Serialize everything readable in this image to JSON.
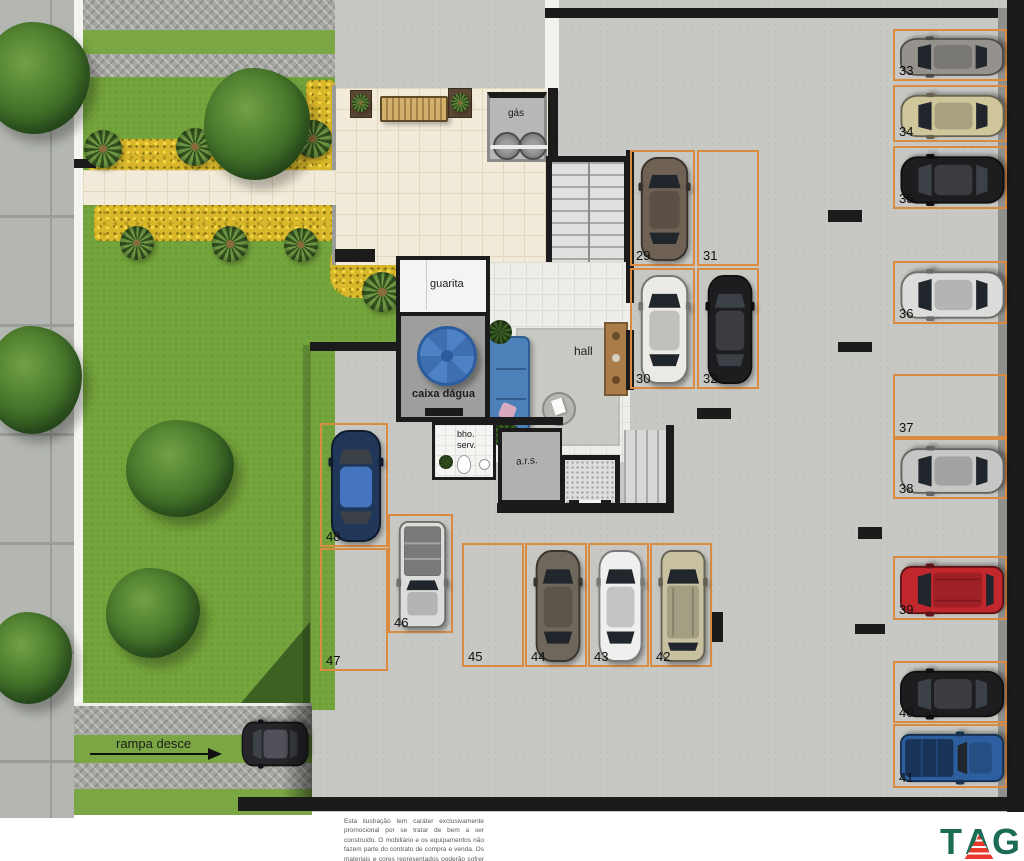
{
  "plan": {
    "labels": {
      "gas": "gás",
      "guarita": "guarita",
      "caixa_dagua": "caixa dágua",
      "hall": "hall",
      "bho_serv_line1": "bho.",
      "bho_serv_line2": "serv.",
      "ars": "a.r.s.",
      "ramp": "rampa desce"
    },
    "colors": {
      "stall_outline": "#db8b41",
      "garage_floor": "#c7c8c4",
      "lawn": "#74a43c",
      "flowers": "#d9b72b",
      "water_tank": "#4d82c4",
      "logo_green": "#1c6b55",
      "logo_red": "#e8392c"
    },
    "stalls": [
      {
        "num": "29",
        "x": 630,
        "y": 150,
        "w": 65,
        "h": 116,
        "dir": "v",
        "car": {
          "color": "#6f6255",
          "type": "sedan"
        }
      },
      {
        "num": "30",
        "x": 630,
        "y": 268,
        "w": 65,
        "h": 121,
        "dir": "v",
        "car": {
          "color": "#eceae6",
          "type": "sedan"
        }
      },
      {
        "num": "31",
        "x": 697,
        "y": 150,
        "w": 62,
        "h": 116,
        "dir": "v",
        "car": null
      },
      {
        "num": "32",
        "x": 697,
        "y": 268,
        "w": 62,
        "h": 121,
        "dir": "v",
        "car": {
          "color": "#1d1d1f",
          "type": "sedan"
        }
      },
      {
        "num": "33",
        "x": 893,
        "y": 29,
        "w": 114,
        "h": 52,
        "dir": "h",
        "car": {
          "color": "#95928d",
          "type": "sedan"
        }
      },
      {
        "num": "34",
        "x": 893,
        "y": 85,
        "w": 114,
        "h": 57,
        "dir": "h",
        "car": {
          "color": "#cfc69b",
          "type": "sedan"
        }
      },
      {
        "num": "35",
        "x": 893,
        "y": 146,
        "w": 114,
        "h": 63,
        "dir": "h",
        "car": {
          "color": "#1d1d1f",
          "type": "sedan"
        }
      },
      {
        "num": "36",
        "x": 893,
        "y": 261,
        "w": 114,
        "h": 63,
        "dir": "h",
        "car": {
          "color": "#dcdcda",
          "type": "sedan"
        }
      },
      {
        "num": "37",
        "x": 893,
        "y": 374,
        "w": 114,
        "h": 64,
        "dir": "h",
        "car": null
      },
      {
        "num": "38",
        "x": 893,
        "y": 438,
        "w": 114,
        "h": 61,
        "dir": "h",
        "car": {
          "color": "#c6c6c4",
          "type": "sedan"
        }
      },
      {
        "num": "39",
        "x": 893,
        "y": 556,
        "w": 114,
        "h": 64,
        "dir": "h",
        "car": {
          "color": "#c2272d",
          "type": "suv"
        }
      },
      {
        "num": "40",
        "x": 893,
        "y": 661,
        "w": 114,
        "h": 62,
        "dir": "h",
        "car": {
          "color": "#1d1d1f",
          "type": "sedan"
        }
      },
      {
        "num": "41",
        "x": 893,
        "y": 724,
        "w": 114,
        "h": 64,
        "dir": "h",
        "car": {
          "color": "#2d5fa0",
          "type": "pickup"
        }
      },
      {
        "num": "42",
        "x": 650,
        "y": 543,
        "w": 62,
        "h": 124,
        "dir": "v",
        "car": {
          "color": "#c8c1a0",
          "type": "suv"
        }
      },
      {
        "num": "43",
        "x": 588,
        "y": 543,
        "w": 61,
        "h": 124,
        "dir": "v",
        "car": {
          "color": "#efefed",
          "type": "sedan"
        }
      },
      {
        "num": "44",
        "x": 525,
        "y": 543,
        "w": 62,
        "h": 124,
        "dir": "v",
        "car": {
          "color": "#6f675c",
          "type": "sedan"
        }
      },
      {
        "num": "45",
        "x": 462,
        "y": 543,
        "w": 62,
        "h": 124,
        "dir": "v",
        "car": null
      },
      {
        "num": "46",
        "x": 388,
        "y": 514,
        "w": 65,
        "h": 119,
        "dir": "v",
        "car": {
          "color": "#dcdcda",
          "type": "pickup"
        }
      },
      {
        "num": "47",
        "x": 320,
        "y": 548,
        "w": 68,
        "h": 123,
        "dir": "v",
        "car": null
      },
      {
        "num": "48",
        "x": 320,
        "y": 423,
        "w": 68,
        "h": 124,
        "dir": "v",
        "car": {
          "color": "#20375a",
          "type": "sedan"
        }
      }
    ],
    "ramp_car": {
      "x": 237,
      "y": 714,
      "w": 76,
      "h": 60,
      "dir": "h",
      "color": "#26262a",
      "type": "sedan"
    },
    "disclaimer": "Esta ilustração tem caráter exclusivamente promocional por se tratar de bem a ser construído. O mobiliário e os equipamentos não fazem parte do contrato de compra e venda. Os materiais e cores representados poderão sofrer alterações em função da disponibilidade dos mesmos no mercado.",
    "logo": {
      "t": "T",
      "a": "A",
      "g": "G"
    }
  }
}
